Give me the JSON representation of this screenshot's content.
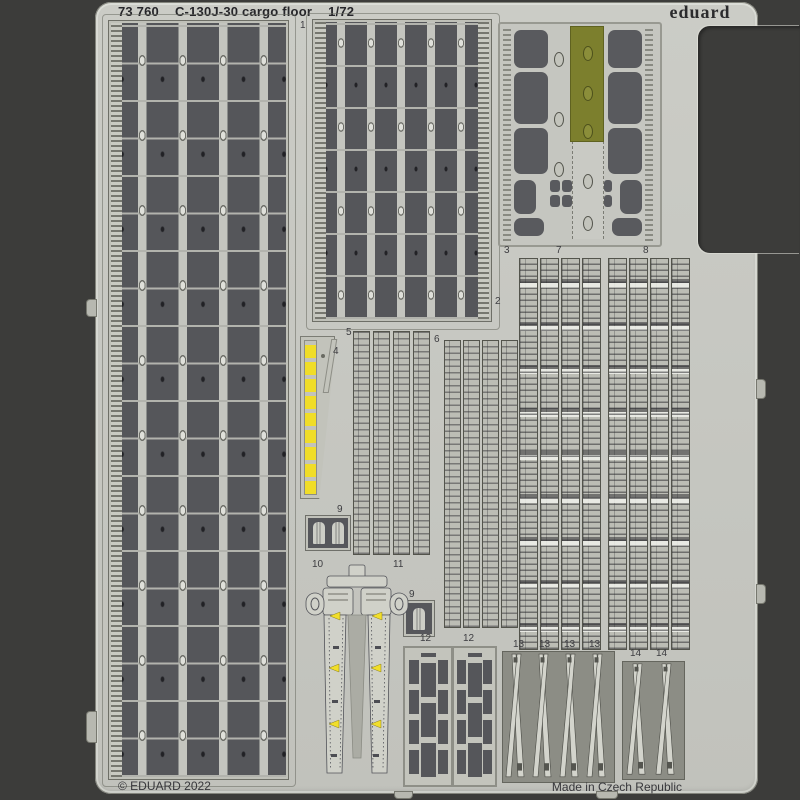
{
  "header": {
    "catalog_number": "73 760",
    "product_name": "C-130J-30 cargo floor",
    "scale": "1/72",
    "brand": "eduard"
  },
  "footer": {
    "copyright": "© EDUARD 2022",
    "origin": "Made in Czech Republic"
  },
  "part_labels": {
    "p1": "1",
    "p2": "2",
    "p3": "3",
    "p4": "4",
    "p5": "5",
    "p6": "6",
    "p7": "7",
    "p8": "8",
    "p9": "9",
    "p10": "10",
    "p11": "11",
    "p12": "12",
    "p13": "13",
    "p14": "14"
  },
  "colors": {
    "background": "#3c3c3a",
    "fret_metal": "#c6c7c1",
    "panel_dark": "#55565a",
    "olive_paint": "#7c7f2d",
    "yellow_paint": "#f0dd28",
    "text": "#26262a"
  }
}
